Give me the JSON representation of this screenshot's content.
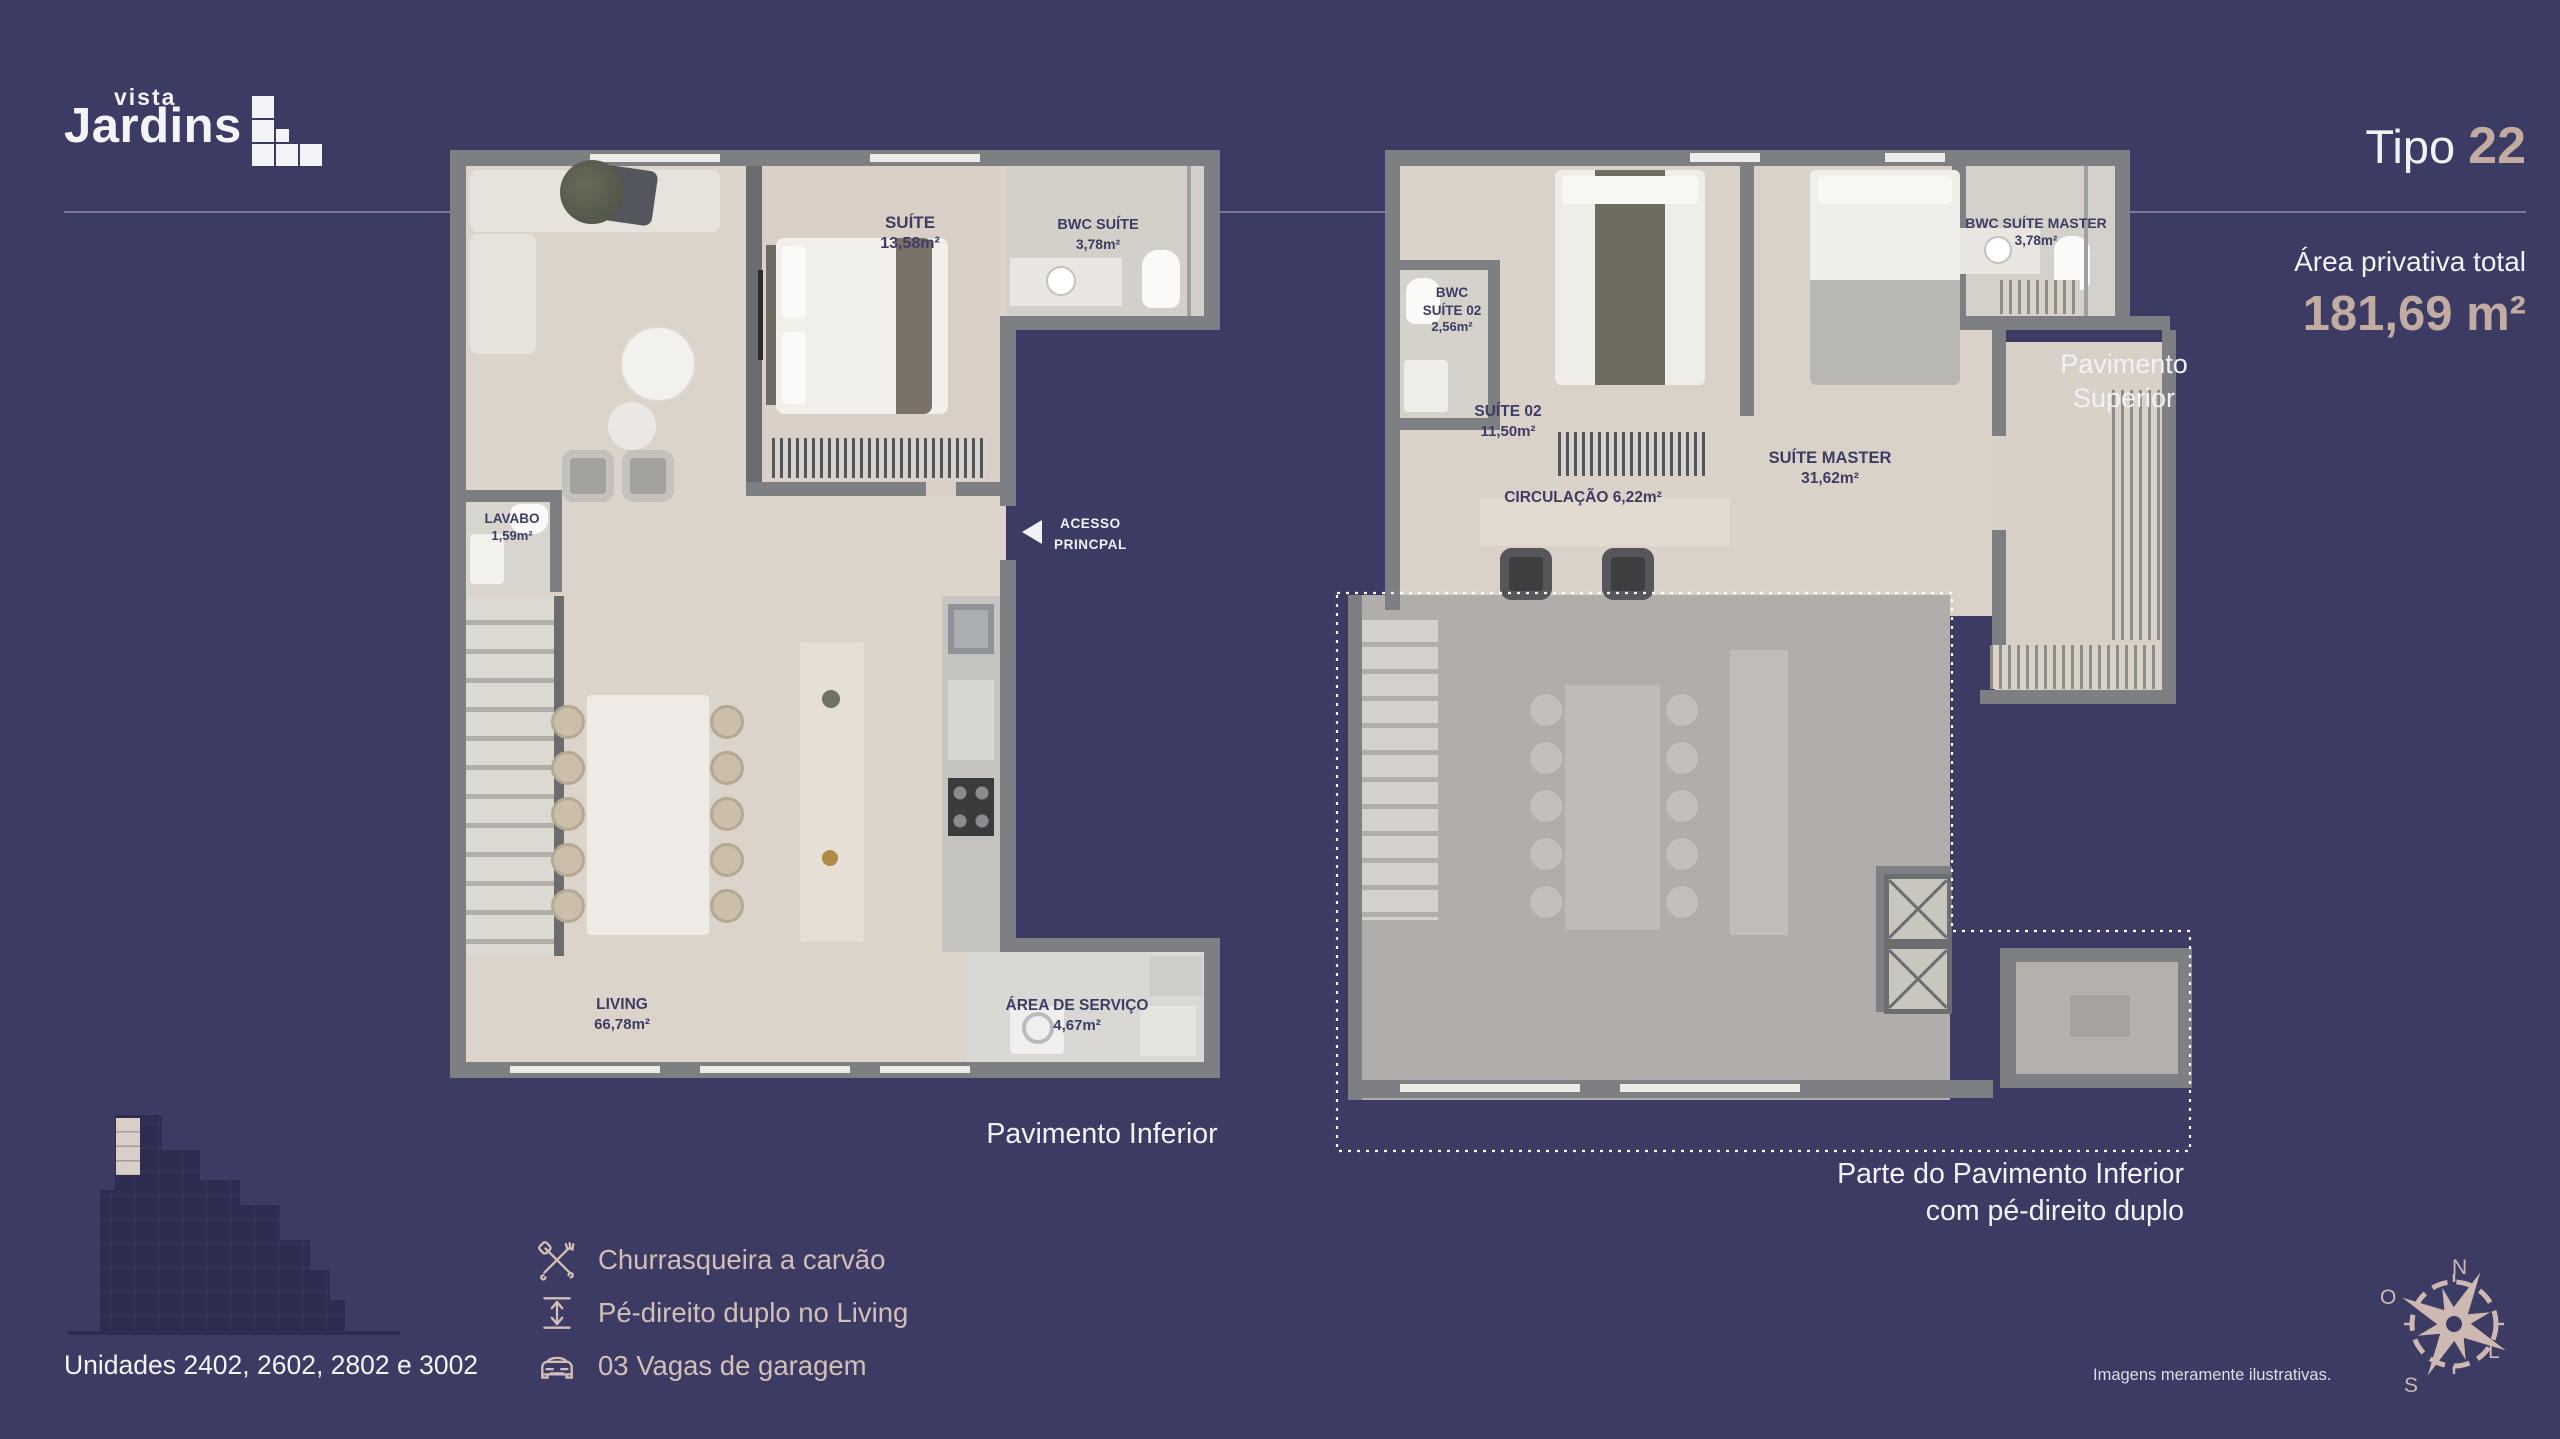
{
  "colors": {
    "background": "#3B3B63",
    "accent": "#C2ACA2",
    "amenity_text": "#D3BFB8"
  },
  "logo": {
    "top": "vista",
    "main": "Jardins"
  },
  "title": {
    "prefix": "Tipo ",
    "number": "22"
  },
  "area": {
    "label": "Área privativa total",
    "value": "181,69 m²"
  },
  "plan_inferior": {
    "caption": "Pavimento Inferior",
    "suite_name": "SUÍTE",
    "suite_area": "13,58m²",
    "bwc_name": "BWC SUÍTE",
    "bwc_area": "3,78m²",
    "lavabo_name": "LAVABO",
    "lavabo_area": "1,59m²",
    "living_name": "LIVING",
    "living_area": "66,78m²",
    "servico_name": "ÁREA DE SERVIÇO",
    "servico_area": "4,67m²",
    "acesso": "ACESSO\nPRINCPAL"
  },
  "plan_superior": {
    "caption": "Pavimento\nSuperior",
    "bwc02_name": "BWC\nSUÍTE 02",
    "bwc02_area": "2,56m²",
    "suite02_name": "SUÍTE 02",
    "suite02_area": "11,50m²",
    "master_name": "SUÍTE MASTER",
    "master_area": "31,62m²",
    "bwcmaster_name": "BWC SUÍTE MASTER",
    "bwcmaster_area": "3,78m²",
    "circulacao": "CIRCULAÇÃO 6,22m²",
    "note": "Parte do Pavimento Inferior\ncom pé-direito duplo"
  },
  "units_label": "Unidades 2402, 2602, 2802 e 3002",
  "amenities": [
    {
      "icon": "bbq-icon",
      "label": "Churrasqueira a carvão"
    },
    {
      "icon": "ceiling-height-icon",
      "label": "Pé-direito duplo no Living"
    },
    {
      "icon": "car-icon",
      "label": "03 Vagas de garagem"
    }
  ],
  "compass": {
    "n": "N",
    "s": "S",
    "o": "O",
    "l": "L"
  },
  "disclaimer": "Imagens meramente ilustrativas."
}
